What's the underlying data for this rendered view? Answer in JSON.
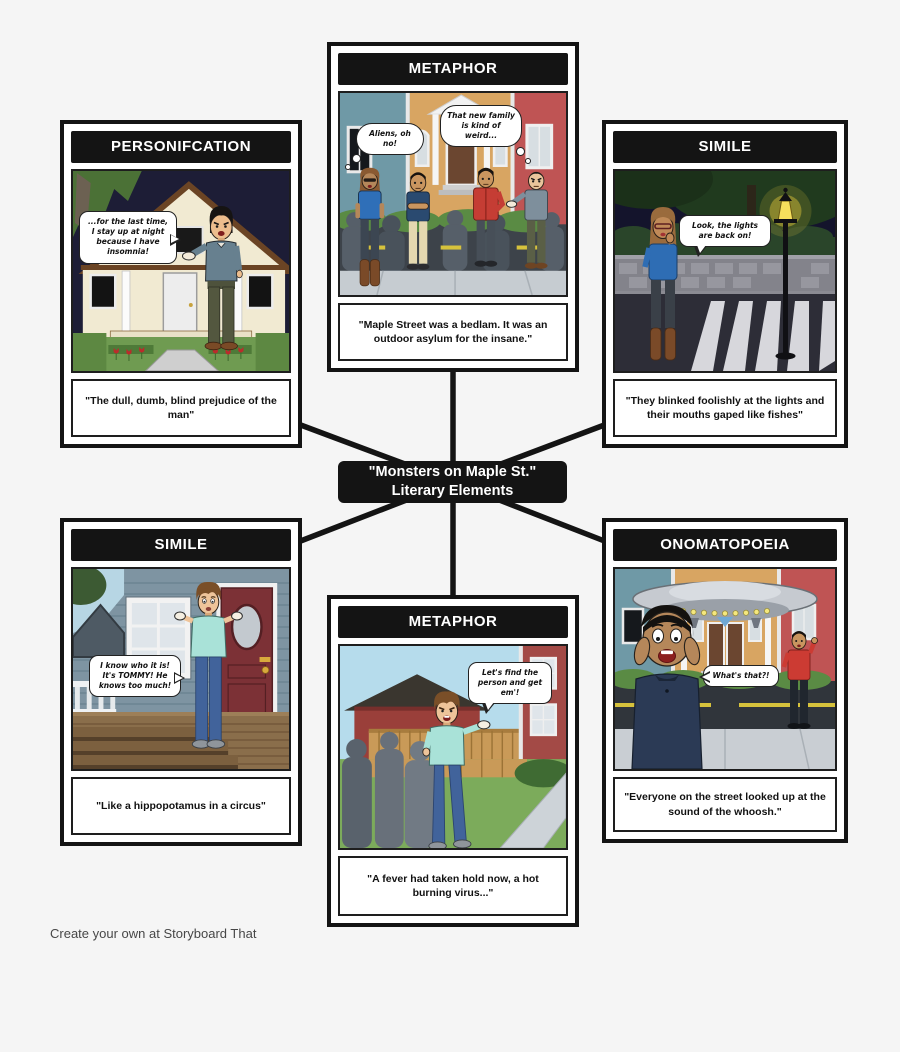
{
  "title": {
    "line1": "\"Monsters on Maple St.\"",
    "line2": "Literary Elements"
  },
  "footer": "Create your own at Storyboard That",
  "panels": {
    "personification": {
      "header": "PERSONIFCATION",
      "bubble": "...for the last time, I stay up at night because I have insomnia!",
      "caption": "\"The dull, dumb, blind prejudice of the man\""
    },
    "metaphor_top": {
      "header": "METAPHOR",
      "bubble_left": "Aliens, oh no!",
      "bubble_right": "That new family is kind of weird...",
      "caption": "\"Maple Street was a bedlam. It was an outdoor asylum for the insane.\""
    },
    "simile_top": {
      "header": "SIMILE",
      "bubble": "Look, the lights are back on!",
      "caption": "\"They blinked foolishly at the lights and their mouths gaped like fishes\""
    },
    "simile_bottom": {
      "header": "SIMILE",
      "bubble": "I know who it is! It's TOMMY! He knows too much!",
      "caption": "\"Like a hippopotamus in a circus\""
    },
    "metaphor_bottom": {
      "header": "METAPHOR",
      "bubble": "Let's find the person and get em'!",
      "caption": "\"A fever had taken hold now, a hot burning virus...\""
    },
    "onomatopoeia": {
      "header": "ONOMATOPOEIA",
      "bubble": "What's that?!",
      "caption": "\"Everyone on the street looked up at the sound of the whoosh.\""
    }
  },
  "colors": {
    "background": "#f5f5f5",
    "panel_border": "#141414",
    "header_bg": "#141414",
    "header_text": "#ffffff",
    "connector": "#141414",
    "night_sky": "#1d1d36",
    "day_sky": "#b6dcec",
    "grass": "#6f9b51",
    "tan_house": "#d8a562",
    "red_house": "#bf5454",
    "blue_house": "#6f99a6",
    "lamp_glow": "#f2d23c"
  }
}
